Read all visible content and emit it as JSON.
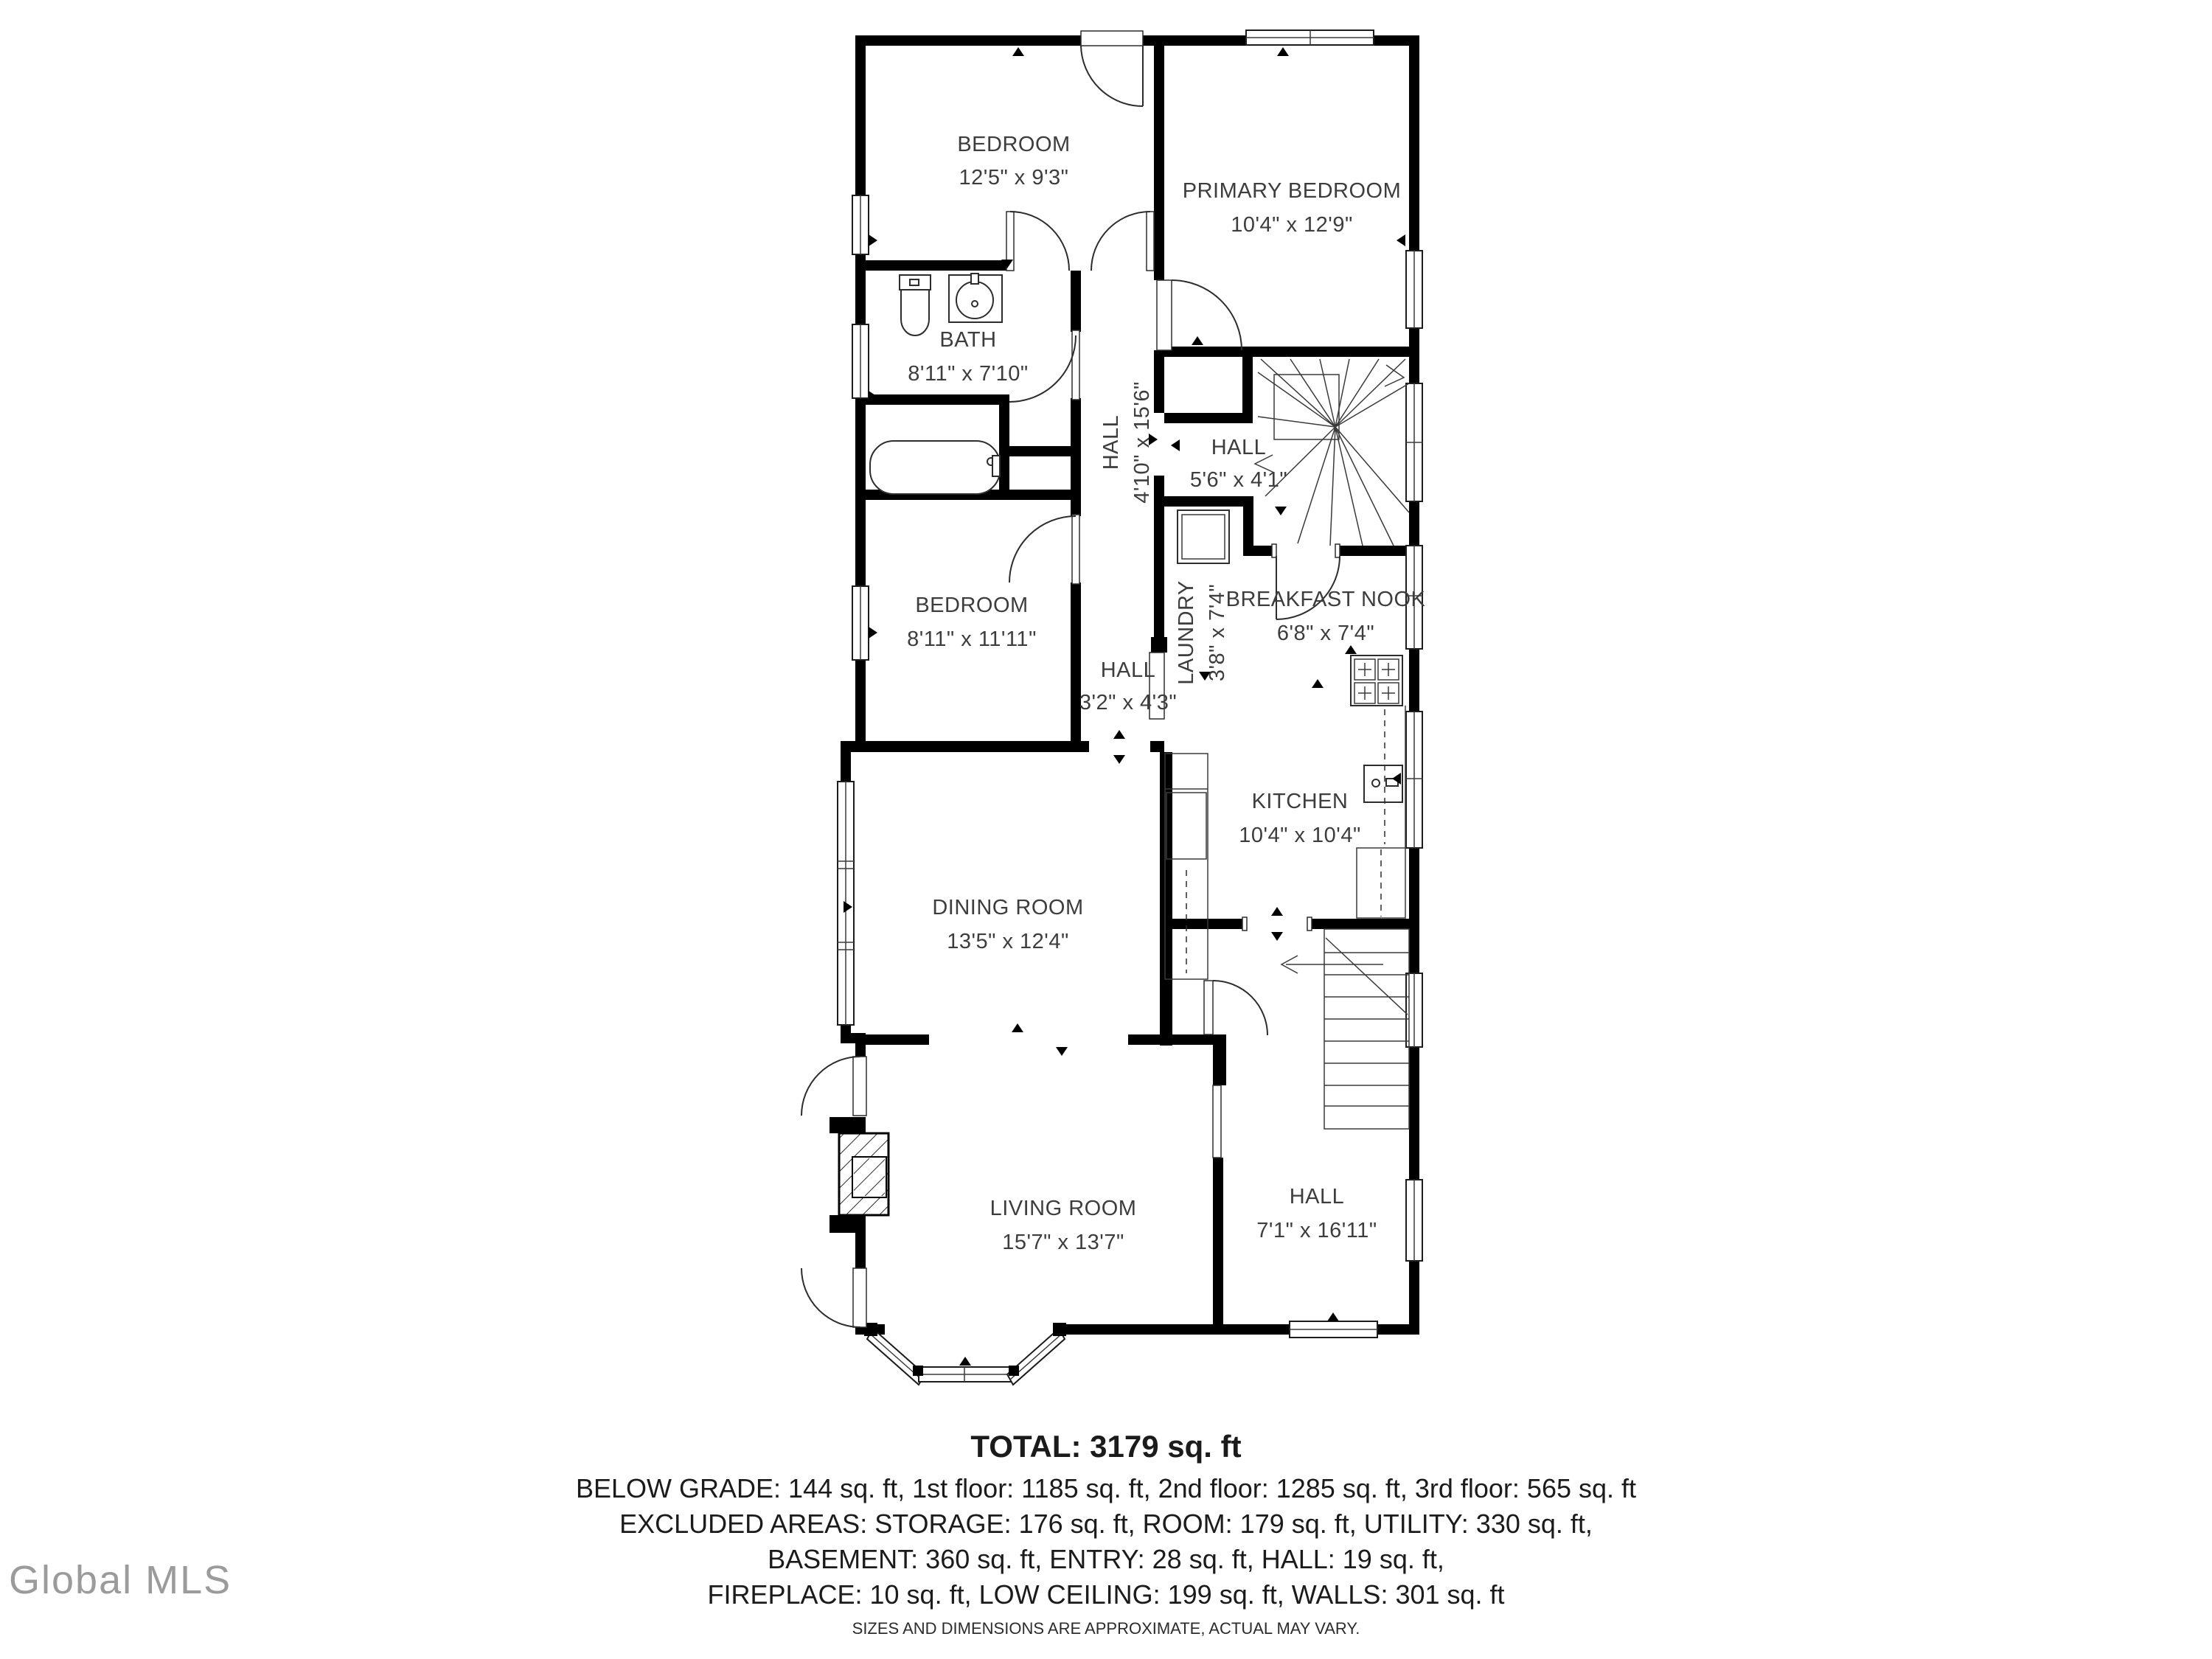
{
  "watermark": "Global MLS",
  "floorplan": {
    "rooms": {
      "bedroom_top": {
        "name": "BEDROOM",
        "dims": "12'5\" x 9'3\""
      },
      "primary_bedroom": {
        "name": "PRIMARY BEDROOM",
        "dims": "10'4\" x 12'9\""
      },
      "bath": {
        "name": "BATH",
        "dims": "8'11\" x 7'10\""
      },
      "hall_upper": {
        "name": "HALL",
        "dims": "4'10\" x 15'6\""
      },
      "hall_stairs": {
        "name": "HALL",
        "dims": "5'6\" x 4'1\""
      },
      "bedroom_mid": {
        "name": "BEDROOM",
        "dims": "8'11\" x 11'11\""
      },
      "laundry": {
        "name": "LAUNDRY",
        "dims": "3'8\" x 7'4\""
      },
      "breakfast_nook": {
        "name": "BREAKFAST NOOK",
        "dims": "6'8\" x 7'4\""
      },
      "kitchen": {
        "name": "KITCHEN",
        "dims": "10'4\" x 10'4\""
      },
      "hall_small": {
        "name": "HALL",
        "dims": "3'2\" x 4'3\""
      },
      "dining_room": {
        "name": "DINING ROOM",
        "dims": "13'5\" x 12'4\""
      },
      "living_room": {
        "name": "LIVING ROOM",
        "dims": "15'7\" x 13'7\""
      },
      "hall_entry": {
        "name": "HALL",
        "dims": "7'1\" x 16'11\""
      }
    },
    "summary": {
      "total": "TOTAL: 3179 sq. ft",
      "line1": "BELOW GRADE: 144 sq. ft, 1st floor: 1185 sq. ft, 2nd floor: 1285 sq. ft, 3rd floor: 565 sq. ft",
      "line2": "EXCLUDED AREAS: STORAGE: 176 sq. ft, ROOM: 179 sq. ft, UTILITY: 330 sq. ft,",
      "line3": "BASEMENT: 360 sq. ft, ENTRY: 28 sq. ft, HALL: 19 sq. ft,",
      "line4": "FIREPLACE: 10 sq. ft, LOW CEILING: 199 sq. ft, WALLS: 301 sq. ft",
      "disclaimer": "SIZES AND DIMENSIONS ARE APPROXIMATE, ACTUAL MAY VARY."
    }
  }
}
